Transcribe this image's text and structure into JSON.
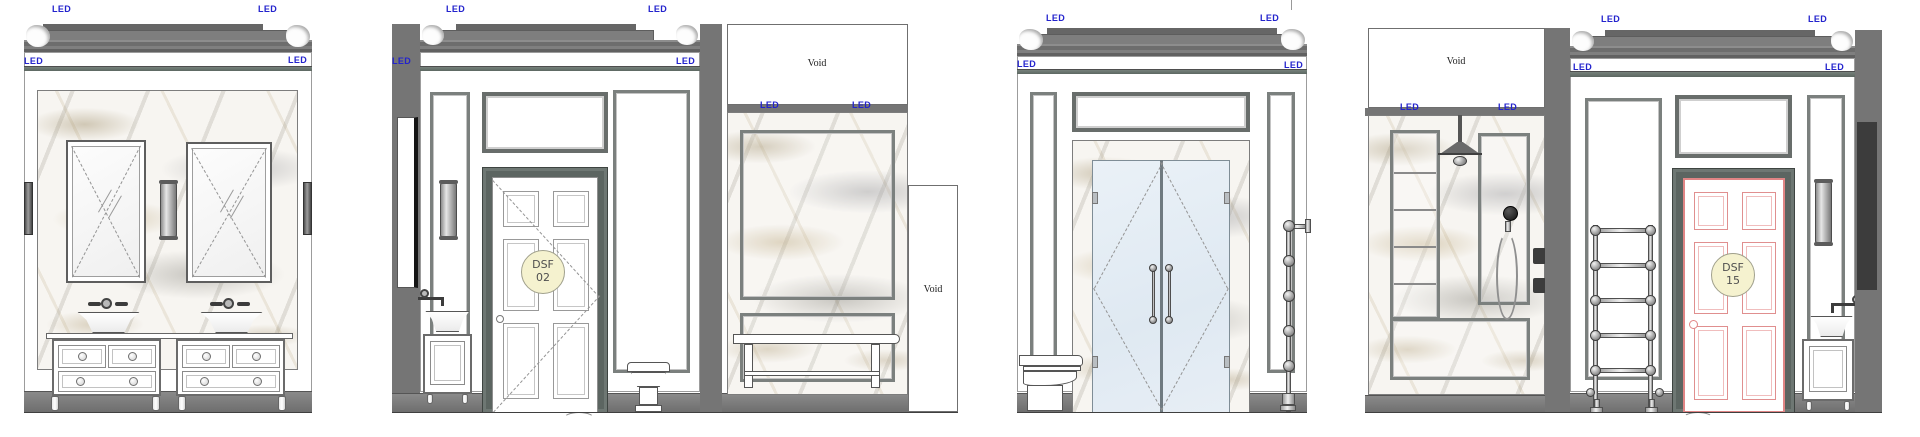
{
  "labels": {
    "led": "LED",
    "void": "Void"
  },
  "door_tags": {
    "dsf02": {
      "code": "DSF",
      "number": "02"
    },
    "dsf15": {
      "code": "DSF",
      "number": "15"
    }
  },
  "colors": {
    "led_text": "#2323cd",
    "structure_gray": "#757575",
    "door_frame": "#5c6561",
    "tag_fill": "#f5f2cf",
    "flagged_door_outline": "#e08585",
    "glass_tint": "#e3ecf4",
    "marble_vein_gold": "#b39a6a",
    "marble_vein_gray": "#9b9b9b",
    "skirting_gray": "#7a7a7a"
  }
}
